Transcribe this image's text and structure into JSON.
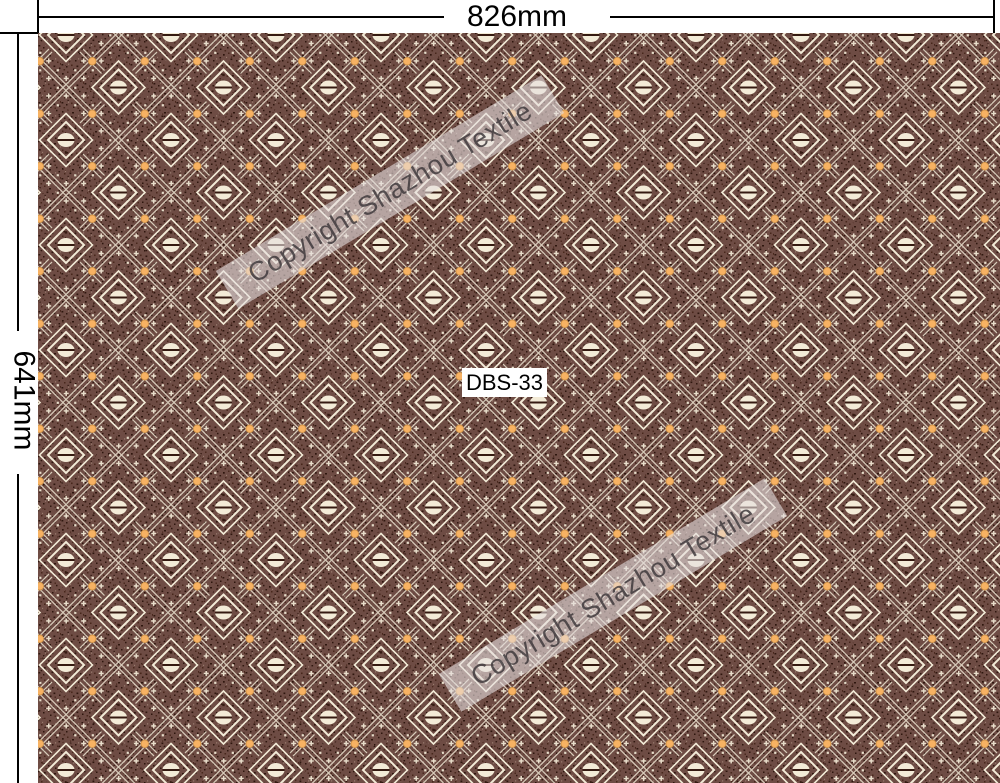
{
  "dimension_annotations": {
    "width_label": "826mm",
    "height_label": "641mm"
  },
  "swatch": {
    "pattern_code": "DBS-33",
    "watermarks": [
      {
        "text": "Copyright Shazhou Textile"
      },
      {
        "text": "Copyright Shazhou Textile"
      }
    ]
  },
  "palette": {
    "page_bg": "#ffffff",
    "dim_line": "#000000",
    "dim_text": "#000000",
    "base": "#6e4c44",
    "cream": "#f3ebd7",
    "orange": "#f7b263",
    "orange_edge": "#cd8f43",
    "slit_dark": "#351a11",
    "speck_dark": "#2a120b",
    "speck_mid": "#45241a",
    "speck_light": "#9e8174",
    "watermark_band": "rgba(230,224,223,0.60)",
    "watermark_text": "rgba(64,58,60,0.85)",
    "code_bg": "#ffffff",
    "code_text": "#000000"
  }
}
